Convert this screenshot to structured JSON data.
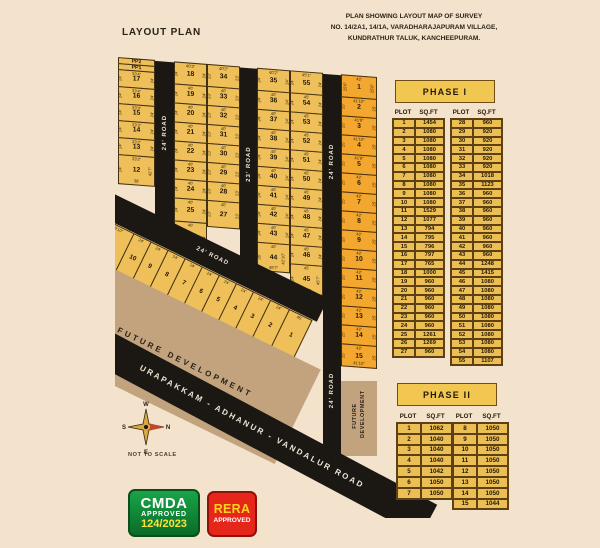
{
  "page_title": "LAYOUT PLAN",
  "survey_note": {
    "line1": "PLAN SHOWING LAYOUT MAP OF SURVEY",
    "line2": "NO. 14/2A1, 14/1A, VARADHARAJAPURAM VILLAGE,",
    "line3": "KUNDRATHUR TALUK, KANCHEEPURAM."
  },
  "colors": {
    "background": "#f3e2cc",
    "phase1_plot": "#efc05a",
    "phase2_plot": "#f4a72e",
    "road": "#1b1713",
    "future_dev": "#c2a37e",
    "table_cell": "#ecbf55",
    "cmda_green": "#0e8f35",
    "rera_red": "#e7261b",
    "badge_yellow": "#ffe13a",
    "north_red": "#c2452c"
  },
  "map": {
    "columns": [
      {
        "name": "col-a",
        "x": 118,
        "w": 37,
        "phase": 1,
        "cells": [
          {
            "n": "PP2",
            "h": 7
          },
          {
            "n": "PP1",
            "h": 7
          },
          {
            "n": "17",
            "h": 18,
            "w": "33'4\"",
            "d": "24'"
          },
          {
            "n": "16",
            "h": 18,
            "w": "33'4\"",
            "d": "24'"
          },
          {
            "n": "15",
            "h": 18,
            "w": "33'3\"",
            "d": "24'"
          },
          {
            "n": "14",
            "h": 18,
            "w": "33'3\"",
            "d": "24'"
          },
          {
            "n": "13",
            "h": 18,
            "w": "33'2\"",
            "d": "24'"
          },
          {
            "n": "12",
            "h": 30,
            "w": "33'2\"",
            "dl": "24'",
            "dr": "42'7\"",
            "b": "38'"
          }
        ]
      },
      {
        "name": "col-b",
        "x": 174,
        "w": 33,
        "phase": 1,
        "cells": [
          {
            "n": "18",
            "h": 23,
            "w": "40'3\"",
            "d": "24'"
          },
          {
            "n": "19",
            "h": 20,
            "w": "40'",
            "d": "24'"
          },
          {
            "n": "20",
            "h": 20,
            "w": "40'",
            "d": "24'"
          },
          {
            "n": "21",
            "h": 20,
            "w": "40'",
            "d": "24'"
          },
          {
            "n": "22",
            "h": 20,
            "w": "40'",
            "d": "24'"
          },
          {
            "n": "23",
            "h": 20,
            "w": "40'",
            "d": "24'"
          },
          {
            "n": "24",
            "h": 20,
            "w": "40'",
            "d": "24'"
          },
          {
            "n": "25",
            "h": 24,
            "w": "40'",
            "d": "24'"
          },
          {
            "n": "26",
            "h": 31,
            "w": "40'",
            "d": "24'",
            "b": "46'1\""
          }
        ]
      },
      {
        "name": "col-c",
        "x": 207,
        "w": 33,
        "phase": 1,
        "cells": [
          {
            "n": "34",
            "h": 23,
            "w": "40'2\"",
            "d": "23'"
          },
          {
            "n": "33",
            "h": 20,
            "w": "40'",
            "d": "23'"
          },
          {
            "n": "32",
            "h": 20,
            "w": "40'",
            "d": "23'"
          },
          {
            "n": "31",
            "h": 20,
            "w": "40'",
            "d": "23'"
          },
          {
            "n": "30",
            "h": 20,
            "w": "40'",
            "d": "23'"
          },
          {
            "n": "29",
            "h": 20,
            "w": "40'",
            "d": "23'"
          },
          {
            "n": "28",
            "h": 20,
            "w": "40'",
            "d": "23'"
          },
          {
            "n": "27",
            "h": 27,
            "w": "40'",
            "d": "23'"
          }
        ]
      },
      {
        "name": "col-d",
        "x": 257,
        "w": 33,
        "phase": 1,
        "cells": [
          {
            "n": "35",
            "h": 23,
            "w": "40'2\"",
            "d": "24'"
          },
          {
            "n": "36",
            "h": 20,
            "w": "40'",
            "d": "24'"
          },
          {
            "n": "37",
            "h": 20,
            "w": "40'",
            "d": "24'"
          },
          {
            "n": "38",
            "h": 20,
            "w": "40'",
            "d": "24'"
          },
          {
            "n": "39",
            "h": 20,
            "w": "40'",
            "d": "24'"
          },
          {
            "n": "40",
            "h": 20,
            "w": "40'",
            "d": "24'"
          },
          {
            "n": "41",
            "h": 20,
            "w": "40'",
            "d": "24'"
          },
          {
            "n": "42",
            "h": 20,
            "w": "40'",
            "d": "24'"
          },
          {
            "n": "43",
            "h": 20,
            "w": "40'",
            "d": "24'"
          },
          {
            "n": "44",
            "h": 29,
            "w": "40'",
            "dl": "26'",
            "dr": "42'10\"",
            "b": "46'7\""
          }
        ]
      },
      {
        "name": "col-e",
        "x": 290,
        "w": 33,
        "phase": 1,
        "cells": [
          {
            "n": "55",
            "h": 23,
            "w": "45'1\"",
            "d": "24'"
          },
          {
            "n": "54",
            "h": 20,
            "w": "45'",
            "d": "24'"
          },
          {
            "n": "53",
            "h": 20,
            "w": "45'",
            "d": "24'"
          },
          {
            "n": "52",
            "h": 20,
            "w": "45'",
            "d": "24'"
          },
          {
            "n": "51",
            "h": 20,
            "w": "45'",
            "d": "24'"
          },
          {
            "n": "50",
            "h": 20,
            "w": "45'",
            "d": "24'"
          },
          {
            "n": "49",
            "h": 20,
            "w": "45'",
            "d": "24'"
          },
          {
            "n": "48",
            "h": 20,
            "w": "45'",
            "d": "24'"
          },
          {
            "n": "47",
            "h": 20,
            "w": "45'",
            "d": "24'"
          },
          {
            "n": "46",
            "h": 20,
            "w": "45'",
            "d": "24'"
          },
          {
            "n": "45",
            "h": 30,
            "w": "45'",
            "dl": "24'",
            "dr": "45'7\"",
            "b": "51'9\""
          }
        ]
      },
      {
        "name": "col-f",
        "x": 341,
        "w": 36,
        "phase": 2,
        "cells": [
          {
            "n": "1",
            "h": 23,
            "w": "42'",
            "d": "25'6\""
          },
          {
            "n": "2",
            "h": 20,
            "w": "41'10\"",
            "d": "25'"
          },
          {
            "n": "3",
            "h": 20,
            "w": "41'9\"",
            "d": "25'"
          },
          {
            "n": "4",
            "h": 20,
            "w": "41'10\"",
            "d": "25'"
          },
          {
            "n": "5",
            "h": 20,
            "w": "41'9\"",
            "d": "25'"
          },
          {
            "n": "6",
            "h": 20,
            "w": "42'",
            "d": "25'"
          },
          {
            "n": "7",
            "h": 20,
            "w": "42'",
            "d": "25'"
          },
          {
            "n": "8",
            "h": 20,
            "w": "42'",
            "d": "25'"
          },
          {
            "n": "9",
            "h": 20,
            "w": "42'",
            "d": "25'"
          },
          {
            "n": "10",
            "h": 20,
            "w": "42'",
            "d": "25'"
          },
          {
            "n": "11",
            "h": 20,
            "w": "42'",
            "d": "25'"
          },
          {
            "n": "12",
            "h": 20,
            "w": "42'",
            "d": "25'"
          },
          {
            "n": "13",
            "h": 20,
            "w": "42'",
            "d": "25'"
          },
          {
            "n": "14",
            "h": 20,
            "w": "42'",
            "d": "25'"
          },
          {
            "n": "15",
            "h": 23,
            "w": "42'",
            "d": "25'",
            "b": "41'10\""
          }
        ]
      }
    ],
    "roads": [
      {
        "name": "road-24ft-left",
        "x": 155,
        "w": 19,
        "h": 170,
        "labels": [
          {
            "text": "24' ROAD",
            "pos": 42
          }
        ]
      },
      {
        "name": "road-23ft",
        "x": 240,
        "w": 17,
        "h": 200,
        "labels": [
          {
            "text": "23' ROAD",
            "pos": 48
          }
        ]
      },
      {
        "name": "road-24ft-right",
        "x": 323,
        "w": 18,
        "h": 395,
        "labels": [
          {
            "text": "24' ROAD",
            "pos": 22
          },
          {
            "text": "24' ROAD",
            "pos": 80
          }
        ]
      }
    ],
    "diagonal_road_label": "24' ROAD",
    "diagonal_plots": [
      {
        "n": "11",
        "w": 34,
        "t": "48'10\"",
        "s": "31'9\""
      },
      {
        "n": "10",
        "w": 20,
        "t": "24'"
      },
      {
        "n": "9",
        "w": 20,
        "t": "24'"
      },
      {
        "n": "8",
        "w": 20,
        "t": "24'"
      },
      {
        "n": "7",
        "w": 20,
        "t": "24'"
      },
      {
        "n": "6",
        "w": 20,
        "t": "24'"
      },
      {
        "n": "5",
        "w": 20,
        "t": "24'"
      },
      {
        "n": "4",
        "w": 20,
        "t": "24'"
      },
      {
        "n": "3",
        "w": 20,
        "t": "24'"
      },
      {
        "n": "2",
        "w": 22,
        "t": "24'"
      },
      {
        "n": "1",
        "w": 26,
        "t": "45'"
      }
    ],
    "future_development": "FUTURE DEVELOPMENT",
    "main_road": "URAPAKKAM - ADHANUR - VANDALUR ROAD"
  },
  "compass": {
    "w": "W",
    "s": "S",
    "n": "N",
    "e": "E",
    "note": "NOT TO SCALE"
  },
  "phase1": {
    "title": "PHASE I",
    "headers": [
      "PLOT",
      "SQ.FT"
    ],
    "left": [
      [
        "1",
        "1454"
      ],
      [
        "2",
        "1080"
      ],
      [
        "3",
        "1080"
      ],
      [
        "4",
        "1080"
      ],
      [
        "5",
        "1080"
      ],
      [
        "6",
        "1080"
      ],
      [
        "7",
        "1080"
      ],
      [
        "8",
        "1080"
      ],
      [
        "9",
        "1080"
      ],
      [
        "10",
        "1080"
      ],
      [
        "11",
        "1529"
      ],
      [
        "12",
        "1077"
      ],
      [
        "13",
        "794"
      ],
      [
        "14",
        "795"
      ],
      [
        "15",
        "796"
      ],
      [
        "16",
        "797"
      ],
      [
        "17",
        "765"
      ],
      [
        "18",
        "1000"
      ],
      [
        "19",
        "960"
      ],
      [
        "20",
        "960"
      ],
      [
        "21",
        "960"
      ],
      [
        "22",
        "960"
      ],
      [
        "23",
        "960"
      ],
      [
        "24",
        "960"
      ],
      [
        "25",
        "1261"
      ],
      [
        "26",
        "1269"
      ],
      [
        "27",
        "960"
      ]
    ],
    "right": [
      [
        "28",
        "960"
      ],
      [
        "29",
        "920"
      ],
      [
        "30",
        "920"
      ],
      [
        "31",
        "920"
      ],
      [
        "32",
        "920"
      ],
      [
        "33",
        "920"
      ],
      [
        "34",
        "1018"
      ],
      [
        "35",
        "1123"
      ],
      [
        "36",
        "960"
      ],
      [
        "37",
        "960"
      ],
      [
        "38",
        "960"
      ],
      [
        "39",
        "960"
      ],
      [
        "40",
        "960"
      ],
      [
        "41",
        "960"
      ],
      [
        "42",
        "960"
      ],
      [
        "43",
        "960"
      ],
      [
        "44",
        "1248"
      ],
      [
        "45",
        "1415"
      ],
      [
        "46",
        "1080"
      ],
      [
        "47",
        "1080"
      ],
      [
        "48",
        "1080"
      ],
      [
        "49",
        "1080"
      ],
      [
        "50",
        "1080"
      ],
      [
        "51",
        "1080"
      ],
      [
        "52",
        "1080"
      ],
      [
        "53",
        "1080"
      ],
      [
        "54",
        "1080"
      ],
      [
        "55",
        "1107"
      ]
    ]
  },
  "phase2": {
    "title": "PHASE II",
    "headers": [
      "PLOT",
      "SQ.FT"
    ],
    "left": [
      [
        "1",
        "1062"
      ],
      [
        "2",
        "1040"
      ],
      [
        "3",
        "1040"
      ],
      [
        "4",
        "1040"
      ],
      [
        "5",
        "1042"
      ],
      [
        "6",
        "1050"
      ],
      [
        "7",
        "1050"
      ]
    ],
    "right": [
      [
        "8",
        "1050"
      ],
      [
        "9",
        "1050"
      ],
      [
        "10",
        "1050"
      ],
      [
        "11",
        "1050"
      ],
      [
        "12",
        "1050"
      ],
      [
        "13",
        "1050"
      ],
      [
        "14",
        "1050"
      ],
      [
        "15",
        "1044"
      ]
    ]
  },
  "badges": {
    "cmda_line1": "CMDA",
    "cmda_line2": "APPROVED",
    "cmda_line3": "124/2023",
    "rera_line1": "RERA",
    "rera_line2": "APPROVED"
  }
}
